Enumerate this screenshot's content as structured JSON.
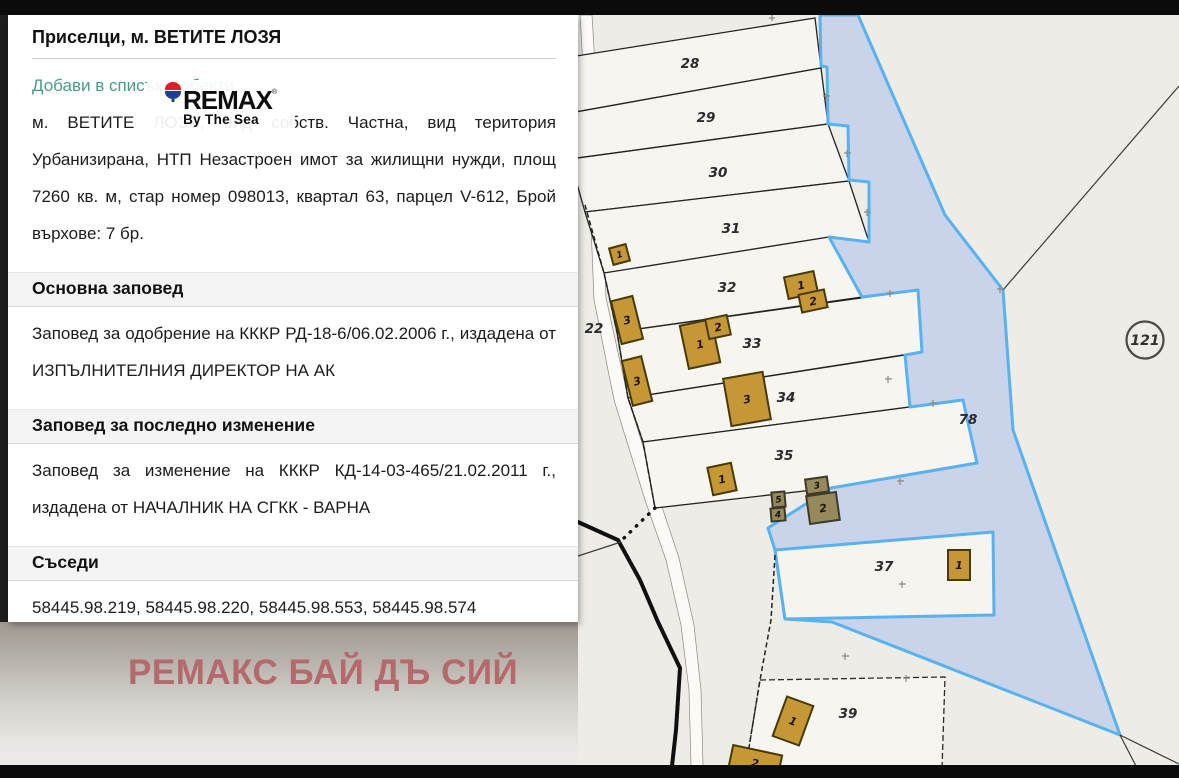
{
  "panel": {
    "title": "Приселци, м. ВЕТИТЕ ЛОЗЯ",
    "add_link_label": "Добави в списък с обекти",
    "description": "м. ВЕТИТЕ ЛОЗЯ, вид собств. Частна, вид територия Урбанизирана, НТП Незастроен имот за жилищни нужди, площ 7260 кв. м, стар номер 098013, квартал 63, парцел V-612, Брой върхове: 7 бр.",
    "sections": {
      "main_order": {
        "heading": "Основна заповед",
        "text": "Заповед за одобрение на КККР РД-18-6/06.02.2006 г., издадена от ИЗПЪЛНИТЕЛНИЯ ДИРЕКТОР НА АК"
      },
      "last_change": {
        "heading": "Заповед за последно изменение",
        "text": "Заповед за изменение на КККР КД-14-03-465/21.02.2011 г., издадена от НАЧАЛНИК НА СГКК - ВАРНА"
      },
      "neighbors": {
        "heading": "Съседи",
        "text": "58445.98.219, 58445.98.220, 58445.98.553, 58445.98.574"
      }
    }
  },
  "logo": {
    "brand": "REMAX",
    "reg": "®",
    "tagline": "By The Sea"
  },
  "watermark": {
    "text": "РЕМАКС БАЙ ДЪ СИЙ",
    "color": "#b4696c"
  },
  "map": {
    "colors": {
      "background": "#edece6",
      "parcel_fill": "#f7f5ef",
      "highlight_fill": "#c9d3e9",
      "highlight_border": "#58b2f0",
      "building_fill": "#c69735"
    },
    "parcel_labels": [
      {
        "text": "28",
        "x": 690,
        "y": 68
      },
      {
        "text": "29",
        "x": 706,
        "y": 122
      },
      {
        "text": "30",
        "x": 718,
        "y": 177
      },
      {
        "text": "31",
        "x": 731,
        "y": 233
      },
      {
        "text": "32",
        "x": 727,
        "y": 292
      },
      {
        "text": "33",
        "x": 752,
        "y": 348
      },
      {
        "text": "34",
        "x": 786,
        "y": 402
      },
      {
        "text": "35",
        "x": 784,
        "y": 460
      },
      {
        "text": "37",
        "x": 884,
        "y": 571
      },
      {
        "text": "39",
        "x": 848,
        "y": 718
      },
      {
        "text": "22",
        "x": 594,
        "y": 333
      },
      {
        "text": "78",
        "x": 968,
        "y": 424
      }
    ],
    "circle_label": {
      "text": "121",
      "x": 1145,
      "y": 340,
      "r": 18.5
    },
    "buildings": [
      {
        "x": 611,
        "y": 246,
        "w": 17,
        "h": 17,
        "rot": -15,
        "label": "1",
        "type": "orange",
        "small": true
      },
      {
        "x": 616,
        "y": 298,
        "w": 22,
        "h": 44,
        "rot": -14,
        "label": "3",
        "type": "orange"
      },
      {
        "x": 786,
        "y": 274,
        "w": 30,
        "h": 22,
        "rot": -12,
        "label": "1",
        "type": "orange"
      },
      {
        "x": 800,
        "y": 292,
        "w": 26,
        "h": 18,
        "rot": -12,
        "label": "2",
        "type": "orange"
      },
      {
        "x": 684,
        "y": 322,
        "w": 32,
        "h": 44,
        "rot": -12,
        "label": "1",
        "type": "orange"
      },
      {
        "x": 707,
        "y": 317,
        "w": 22,
        "h": 20,
        "rot": -12,
        "label": "2",
        "type": "orange"
      },
      {
        "x": 627,
        "y": 358,
        "w": 20,
        "h": 46,
        "rot": -14,
        "label": "3",
        "type": "orange"
      },
      {
        "x": 727,
        "y": 375,
        "w": 40,
        "h": 48,
        "rot": -10,
        "label": "3",
        "type": "orange"
      },
      {
        "x": 710,
        "y": 465,
        "w": 24,
        "h": 28,
        "rot": -12,
        "label": "1",
        "type": "orange"
      },
      {
        "x": 772,
        "y": 492,
        "w": 13,
        "h": 15,
        "rot": -5,
        "label": "5",
        "type": "olive",
        "small": true
      },
      {
        "x": 771,
        "y": 508,
        "w": 14,
        "h": 13,
        "rot": -5,
        "label": "4",
        "type": "olive",
        "small": true
      },
      {
        "x": 806,
        "y": 478,
        "w": 22,
        "h": 15,
        "rot": -8,
        "label": "3",
        "type": "olive",
        "small": true
      },
      {
        "x": 808,
        "y": 494,
        "w": 30,
        "h": 28,
        "rot": -8,
        "label": "2",
        "type": "olive"
      },
      {
        "x": 948,
        "y": 550,
        "w": 22,
        "h": 30,
        "rot": 0,
        "label": "1",
        "type": "orange"
      },
      {
        "x": 779,
        "y": 700,
        "w": 28,
        "h": 42,
        "rot": 20,
        "label": "1",
        "type": "orange"
      },
      {
        "x": 730,
        "y": 750,
        "w": 50,
        "h": 26,
        "rot": 12,
        "label": "2",
        "type": "orange"
      }
    ]
  }
}
